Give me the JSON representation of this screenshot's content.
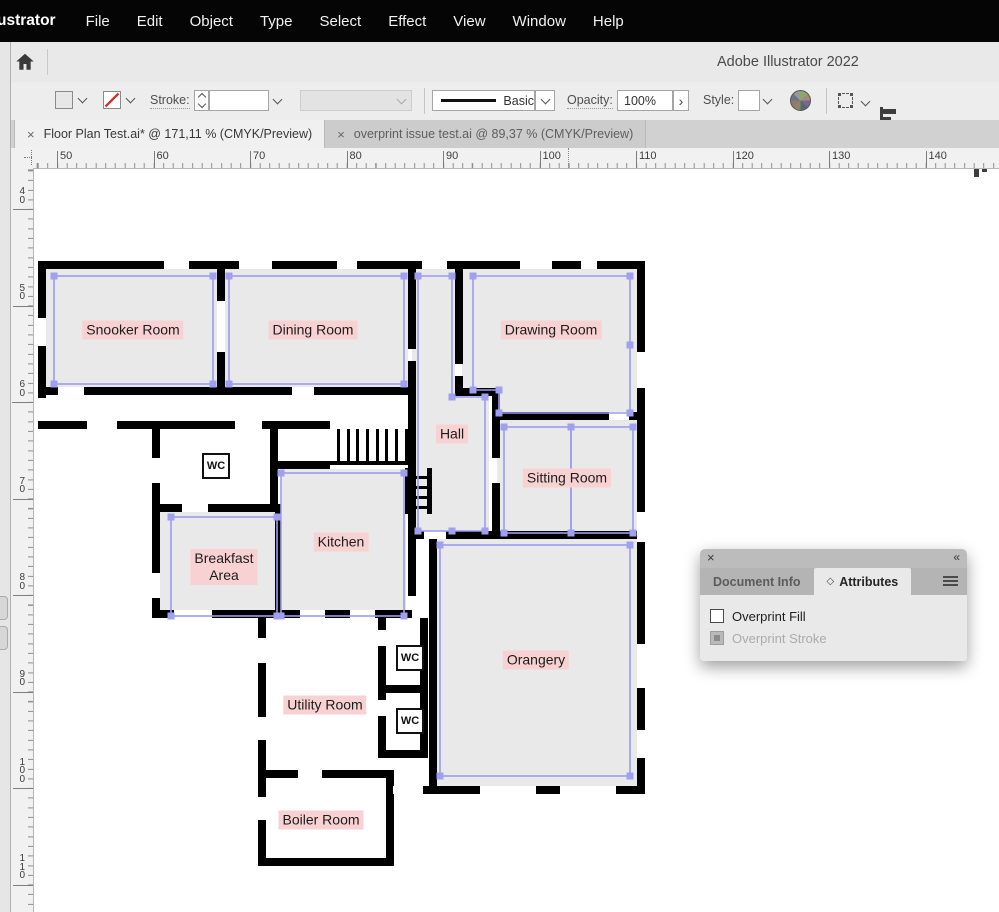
{
  "menu_bar": {
    "app_label": "ustrator",
    "items": [
      "File",
      "Edit",
      "Object",
      "Type",
      "Select",
      "Effect",
      "View",
      "Window",
      "Help"
    ]
  },
  "app_bar": {
    "title": "Adobe Illustrator 2022"
  },
  "control_bar": {
    "stroke_label": "Stroke:",
    "brush_name": "Basic",
    "opacity_label": "Opacity:",
    "opacity_value": "100%",
    "opacity_more": "›",
    "style_label": "Style:"
  },
  "document_tabs": [
    {
      "close": "×",
      "label": "Floor Plan Test.ai* @ 171,11 % (CMYK/Preview)",
      "active": true
    },
    {
      "close": "×",
      "label": "overprint issue test.ai @ 89,37 % (CMYK/Preview)",
      "active": false
    }
  ],
  "rulers": {
    "horizontal_values": [
      50,
      60,
      70,
      80,
      90,
      100,
      110,
      120,
      130,
      140
    ],
    "vertical_values": [
      40,
      50,
      60,
      70,
      80,
      90,
      100,
      110
    ]
  },
  "attributes_panel": {
    "close": "×",
    "collapse": "«",
    "tabs": [
      {
        "label": "Document Info",
        "active": false
      },
      {
        "label": "Attributes",
        "active": true
      }
    ],
    "checkboxes": [
      {
        "label": "Overprint Fill",
        "state": "unchecked"
      },
      {
        "label": "Overprint Stroke",
        "state": "disabled"
      }
    ]
  },
  "floor_plan": {
    "colors": {
      "room_fill": "#e9e9e9",
      "wall": "#000000",
      "selection_stroke": "#9b9bef",
      "handle_fill": "#a0a0f0",
      "label_bg": "#f8d2d2",
      "label_text": "#1c1c1c"
    },
    "labels": [
      {
        "lines": [
          "Snooker Room"
        ],
        "x": 133,
        "y": 330
      },
      {
        "lines": [
          "Dining Room"
        ],
        "x": 313,
        "y": 330
      },
      {
        "lines": [
          "Drawing Room"
        ],
        "x": 551,
        "y": 330
      },
      {
        "lines": [
          "Hall"
        ],
        "x": 452,
        "y": 434
      },
      {
        "lines": [
          "Sitting Room"
        ],
        "x": 567,
        "y": 478
      },
      {
        "lines": [
          "Kitchen"
        ],
        "x": 341,
        "y": 542
      },
      {
        "lines": [
          "Breakfast",
          "Area"
        ],
        "x": 224,
        "y": 567
      },
      {
        "lines": [
          "Orangery"
        ],
        "x": 536,
        "y": 660
      },
      {
        "lines": [
          "Utility Room"
        ],
        "x": 325,
        "y": 705
      },
      {
        "lines": [
          "Boiler Room"
        ],
        "x": 321,
        "y": 820
      }
    ],
    "wc_boxes": [
      {
        "label": "WC",
        "x": 216,
        "y": 466
      },
      {
        "label": "WC",
        "x": 410,
        "y": 658
      },
      {
        "label": "WC",
        "x": 410,
        "y": 721
      }
    ],
    "selection_rects": [
      [
        54,
        276,
        159,
        108
      ],
      [
        229,
        276,
        175,
        108
      ],
      [
        281,
        473,
        123,
        143
      ],
      [
        171,
        517,
        106,
        99
      ],
      [
        440,
        545,
        190,
        231
      ],
      [
        504,
        427,
        67,
        106
      ],
      [
        571,
        427,
        62,
        106
      ]
    ],
    "selection_paths": [
      "M473,276 H630 V413 H499 V390 H473 Z",
      "M418,276 H452 V397 H485 V531 H418 Z"
    ],
    "extra_handles": [
      [
        473,
        276
      ],
      [
        630,
        276
      ],
      [
        630,
        345
      ],
      [
        630,
        413
      ],
      [
        499,
        413
      ],
      [
        499,
        390
      ],
      [
        473,
        390
      ],
      [
        418,
        276
      ],
      [
        452,
        276
      ],
      [
        452,
        397
      ],
      [
        485,
        397
      ],
      [
        418,
        531
      ],
      [
        452,
        531
      ],
      [
        485,
        531
      ]
    ],
    "anchors": [
      [
        130,
        328
      ],
      [
        310,
        328
      ],
      [
        341,
        541
      ],
      [
        247,
        573
      ],
      [
        536,
        659
      ],
      [
        601,
        478
      ]
    ]
  }
}
